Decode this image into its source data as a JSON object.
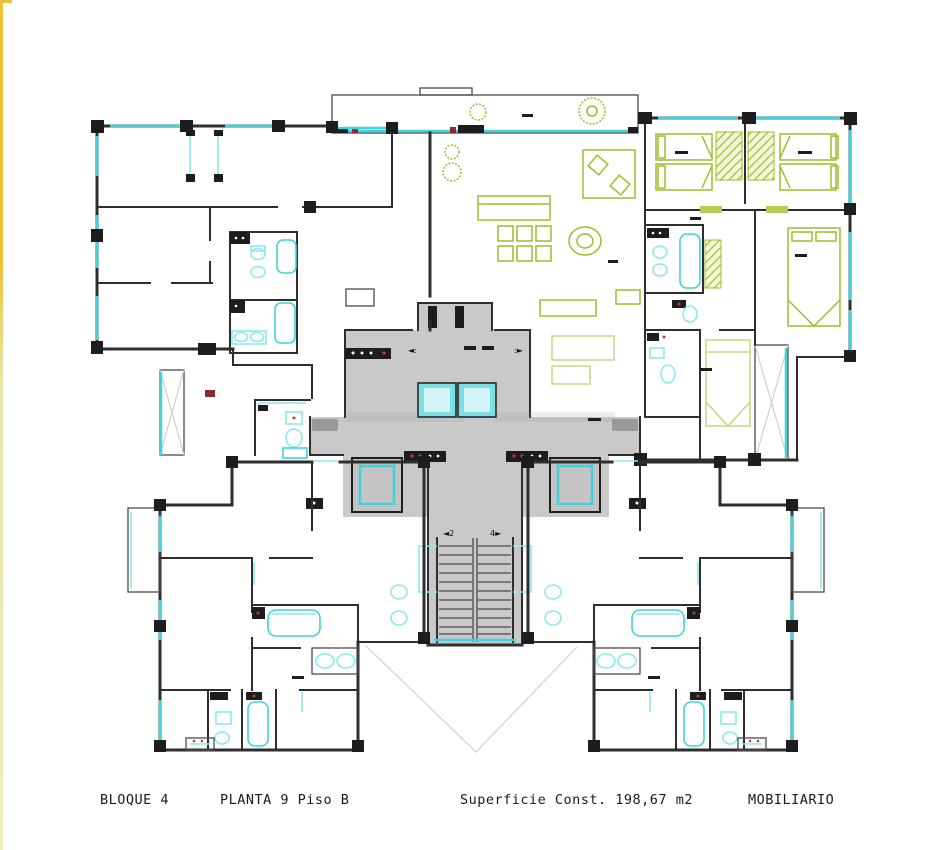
{
  "footer": {
    "block": "BLOQUE 4",
    "floor": "PLANTA 9 Piso B",
    "area": "Superficie Const. 198,67 m2",
    "furnishing": "MOBILIARIO"
  },
  "annotations": {
    "elevator_arrow_left": "◄:",
    "elevator_arrow_right": ":►",
    "stair_arrow_down": "◄2",
    "stair_arrow_up": "4►"
  },
  "colors": {
    "wall": "#2e2e2e",
    "window_cyan": "#3ed3de",
    "window_cyan_light": "#8ce7ee",
    "furniture_green": "#9ebc2d",
    "furniture_pale": "#c9d584",
    "core_gray": "#c9c9c9",
    "elevator_cyan": "#7adee3",
    "accent_red": "#8b2a2a",
    "edge_yellow": "#eac23a",
    "void_line": "#cfcfcf",
    "text": "#1a1a1a"
  }
}
